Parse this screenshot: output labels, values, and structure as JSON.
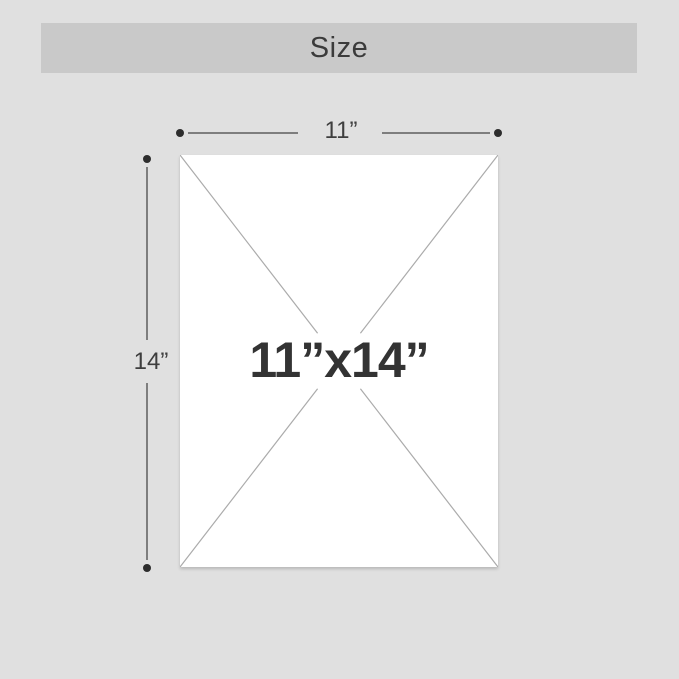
{
  "header": {
    "title": "Size"
  },
  "diagram": {
    "width_label": "11”",
    "height_label": "14”",
    "size_label": "11”x14”"
  },
  "colors": {
    "background": "#e0e0e0",
    "header_band": "#c9c9c9",
    "panel": "#ffffff",
    "diagonal_line": "#ababab",
    "dimension_line": "#7e7e7e",
    "endpoint_dot": "#2d2d2d",
    "label_text": "#3e3e3e",
    "size_text": "#333333"
  }
}
